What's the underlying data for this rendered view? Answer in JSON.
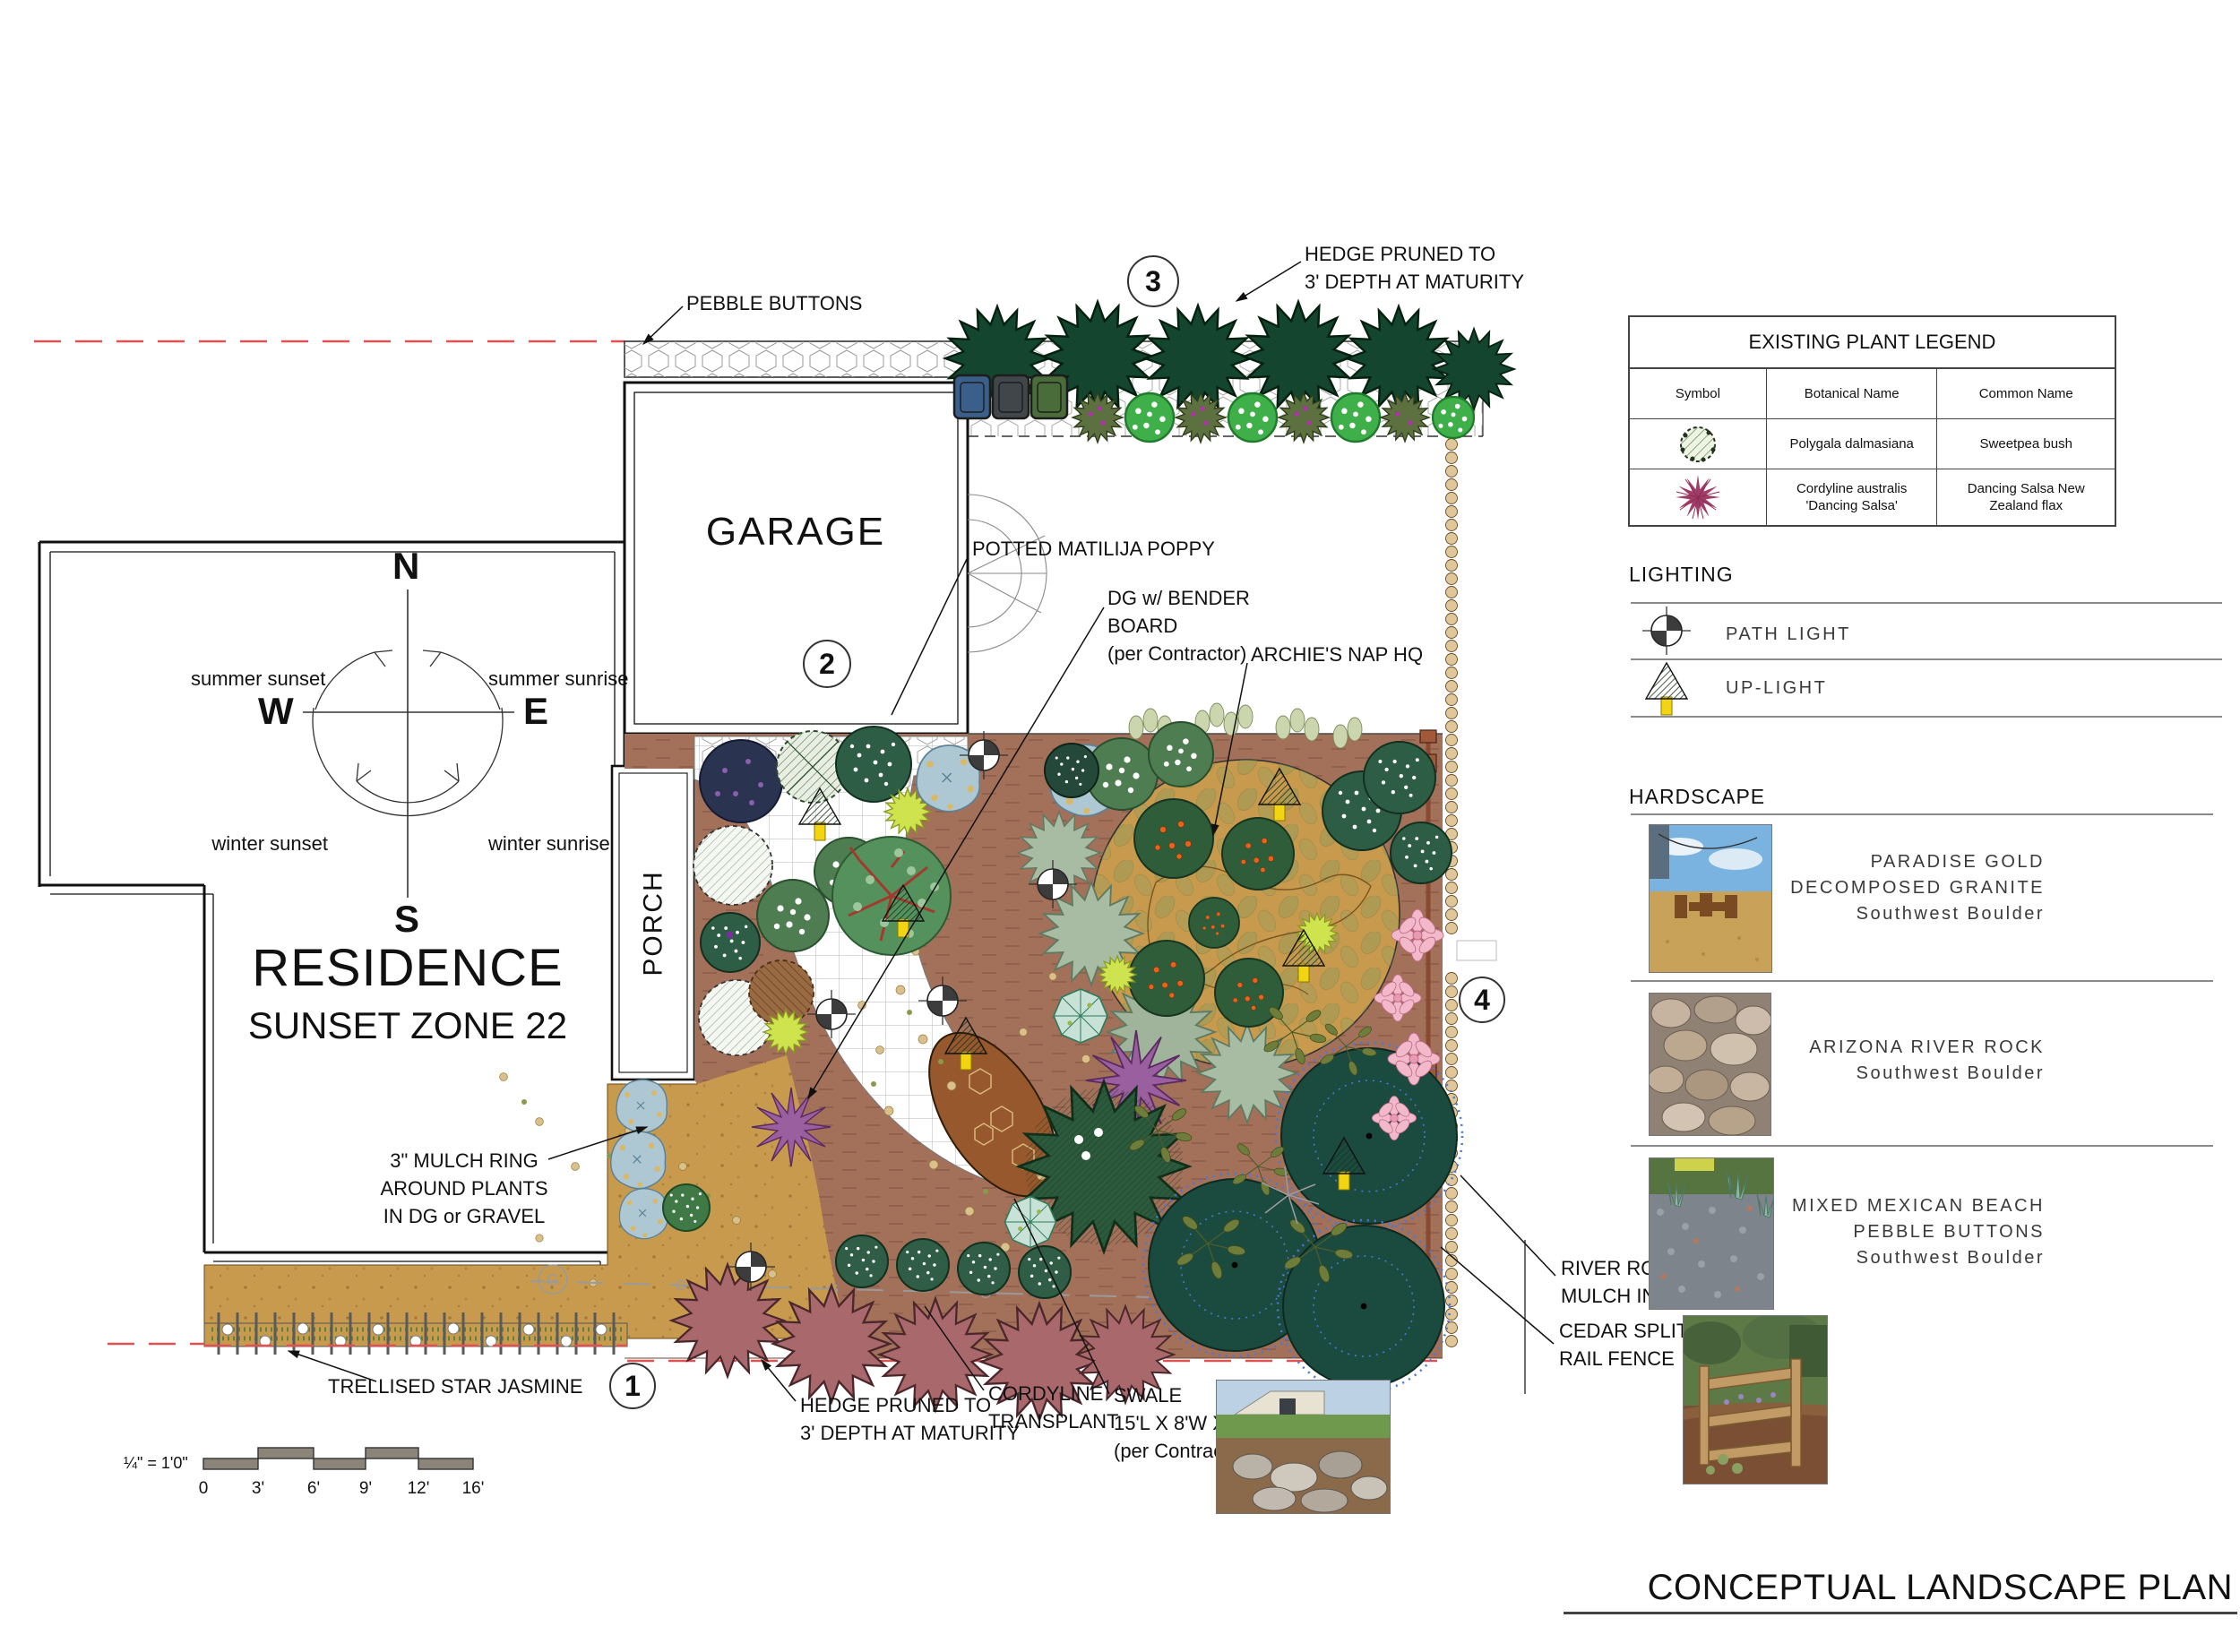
{
  "sheet_title": "CONCEPTUAL LANDSCAPE PLAN",
  "palette": {
    "property_line_red": "#e05252",
    "mulch_brown": "#a3705a",
    "dg_tan": "#c89a4e",
    "hedge_green": "#14452f",
    "transplant_hedge_mauve": "#a9686c",
    "uplight_yellow": "#f2d410",
    "teal_tree": "#1b4a3e",
    "fence_brown": "#8a4a32"
  },
  "plan": {
    "residence_title": "RESIDENCE",
    "residence_subtitle": "SUNSET ZONE 22",
    "garage_label": "GARAGE",
    "porch_label": "PORCH",
    "gas_label": "G",
    "compass": {
      "north": "N",
      "south": "S",
      "east": "E",
      "west": "W",
      "summer_sunset": "summer sunset",
      "summer_sunrise": "summer sunrise",
      "winter_sunset": "winter sunset",
      "winter_sunrise": "winter sunrise"
    },
    "markers": {
      "one": "1",
      "two": "2",
      "three": "3",
      "four": "4"
    },
    "annotations": {
      "pebble_buttons": {
        "lines": [
          "PEBBLE BUTTONS"
        ]
      },
      "hedge_top": {
        "lines": [
          "HEDGE PRUNED TO",
          "3' DEPTH AT MATURITY"
        ]
      },
      "potted_poppy": {
        "lines": [
          "POTTED MATILIJA POPPY"
        ]
      },
      "dg_bender": {
        "lines": [
          "DG w/ BENDER",
          "BOARD",
          "(per Contractor)"
        ]
      },
      "archies": {
        "lines": [
          "ARCHIE'S NAP HQ"
        ]
      },
      "mulch_ring": {
        "lines": [
          "3\" MULCH RING",
          "AROUND PLANTS",
          "IN DG or GRAVEL"
        ]
      },
      "trellis": {
        "lines": [
          "TRELLISED STAR JASMINE"
        ]
      },
      "hedge_bottom": {
        "lines": [
          "HEDGE PRUNED TO",
          "3' DEPTH AT MATURITY"
        ]
      },
      "cordyline": {
        "lines": [
          "CORDYLINE",
          "TRANSPLANT"
        ]
      },
      "swale": {
        "lines": [
          "SWALE",
          "15'L X 8'W X 2'D",
          "(per Contractor)"
        ]
      },
      "river_rock": {
        "lines": [
          "RIVER ROCK TO KEEP",
          "MULCH IN PLACE"
        ]
      },
      "cedar_fence": {
        "lines": [
          "CEDAR SPLIT-",
          "RAIL FENCE"
        ]
      }
    },
    "scale_bar": {
      "label": "¼\" = 1'0\"",
      "ticks": [
        "0",
        "3'",
        "6'",
        "9'",
        "12'",
        "16'"
      ]
    }
  },
  "legend": {
    "title": "EXISTING PLANT LEGEND",
    "headers": [
      "Symbol",
      "Botanical Name",
      "Common Name"
    ],
    "rows": [
      {
        "symbol_icon": "sweetpea-plant-symbol",
        "botanical_lines": [
          "Polygala dalmasiana",
          ""
        ],
        "common_lines": [
          "Sweetpea bush",
          ""
        ]
      },
      {
        "symbol_icon": "flax-starburst-symbol",
        "botanical_lines": [
          "Cordyline australis",
          "'Dancing Salsa'"
        ],
        "common_lines": [
          "Dancing Salsa New",
          "Zealand flax"
        ]
      }
    ]
  },
  "lighting": {
    "title": "LIGHTING",
    "items": [
      {
        "icon": "path-light-icon",
        "label": "PATH LIGHT"
      },
      {
        "icon": "up-light-icon",
        "label": "UP-LIGHT"
      }
    ]
  },
  "hardscape": {
    "title": "HARDSCAPE",
    "items": [
      {
        "photo_icon": "decomposed-granite-photo",
        "lines": [
          "PARADISE GOLD",
          "DECOMPOSED GRANITE",
          "Southwest Boulder"
        ]
      },
      {
        "photo_icon": "river-rock-photo",
        "lines": [
          "ARIZONA RIVER ROCK",
          "Southwest Boulder",
          ""
        ]
      },
      {
        "photo_icon": "mexican-pebble-photo",
        "lines": [
          "MIXED MEXICAN BEACH",
          "PEBBLE BUTTONS",
          "Southwest Boulder"
        ]
      }
    ]
  },
  "side_notes": {
    "river_rock": {
      "lines": [
        "RIVER ROCK TO KEEP",
        "MULCH IN PLACE"
      ]
    },
    "cedar_fence": {
      "lines": [
        "CEDAR SPLIT-",
        "RAIL FENCE"
      ]
    }
  }
}
